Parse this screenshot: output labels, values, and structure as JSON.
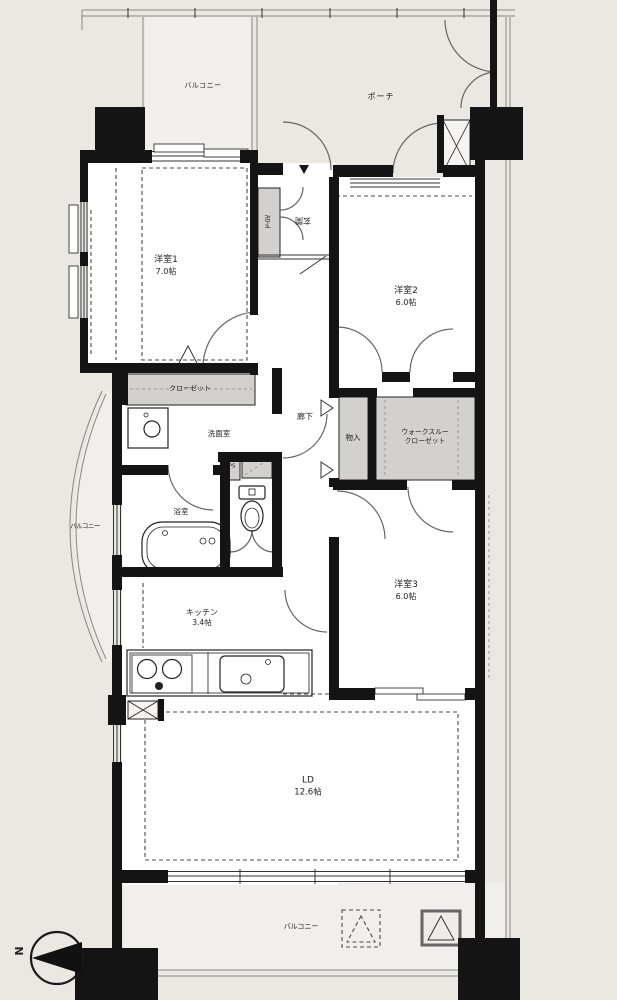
{
  "title": "3LDK apartment floor plan",
  "colors": {
    "background": "#ebe8e3",
    "floor": "#ffffff",
    "balcony_floor": "#f1efeb",
    "wall": "#141414",
    "closet_fill": "#d3d1ce",
    "line": "#555555"
  },
  "compass": {
    "north_label": "N"
  },
  "rooms": {
    "balcony_top": {
      "label": "バルコニー"
    },
    "porch": {
      "label": "ポーチ"
    },
    "room1": {
      "label": "洋室1",
      "size": "7.0帖"
    },
    "entrance": {
      "label": "玄関"
    },
    "shoe_cabinet": {
      "label": "下足"
    },
    "room2": {
      "label": "洋室2",
      "size": "6.0帖"
    },
    "hallway": {
      "label": "廊下"
    },
    "storage": {
      "label": "物入"
    },
    "walkthrough_closet": {
      "label_line1": "ウォークスルー",
      "label_line2": "クローゼット"
    },
    "closet": {
      "label": "クローゼット"
    },
    "washroom": {
      "label": "洗面室"
    },
    "bathroom": {
      "label": "浴室"
    },
    "pipe_space": {
      "label": "PS"
    },
    "balcony_left": {
      "label": "バルコニー"
    },
    "kitchen": {
      "label": "キッチン",
      "size": "3.4帖"
    },
    "room3": {
      "label": "洋室3",
      "size": "6.0帖"
    },
    "living_dining": {
      "label": "LD",
      "size": "12.6帖"
    },
    "balcony_bottom": {
      "label": "バルコニー"
    }
  }
}
